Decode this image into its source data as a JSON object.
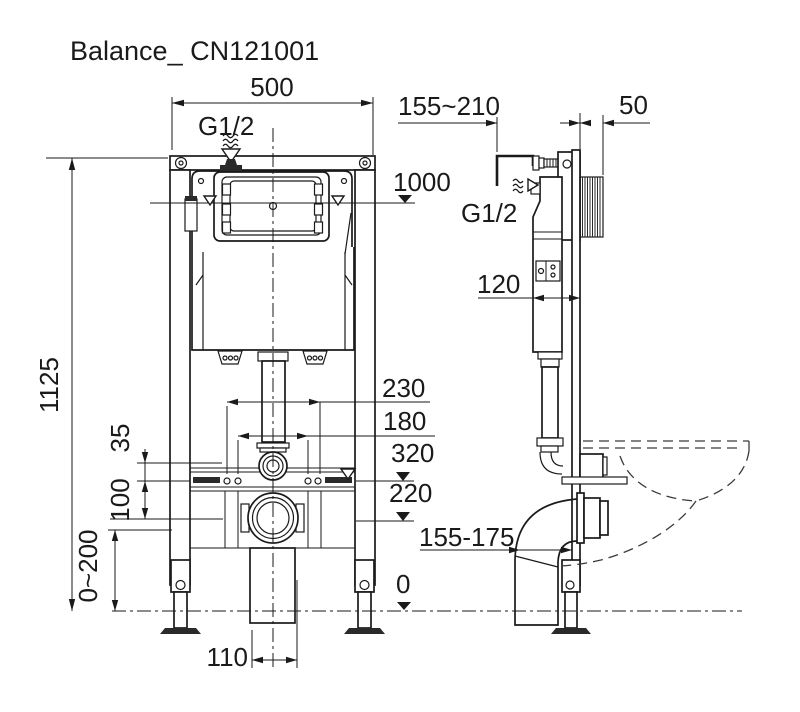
{
  "title": "Balance_ CN121001",
  "colors": {
    "line": "#1a1a1a",
    "background": "#ffffff",
    "dark_fill": "#2a2a2a"
  },
  "front_view": {
    "dims": {
      "frame_width": "500",
      "frame_height": "1125",
      "inlet_thread": "G1/2",
      "flush_plate_height": "1000",
      "fixing_spacing_outer": "230",
      "fixing_spacing_inner": "180",
      "fixing_rail_height": "320",
      "outlet_height": "220",
      "flush_bend_offset": "35",
      "rail_to_outlet": "100",
      "leg_adjustment": "0~200",
      "drain_box_width": "110",
      "floor_level": "0"
    }
  },
  "side_view": {
    "dims": {
      "installation_depth": "155~210",
      "wall_thickness": "50",
      "inlet_thread": "G1/2",
      "cistern_depth": "120",
      "outlet_projection": "155-175"
    }
  }
}
